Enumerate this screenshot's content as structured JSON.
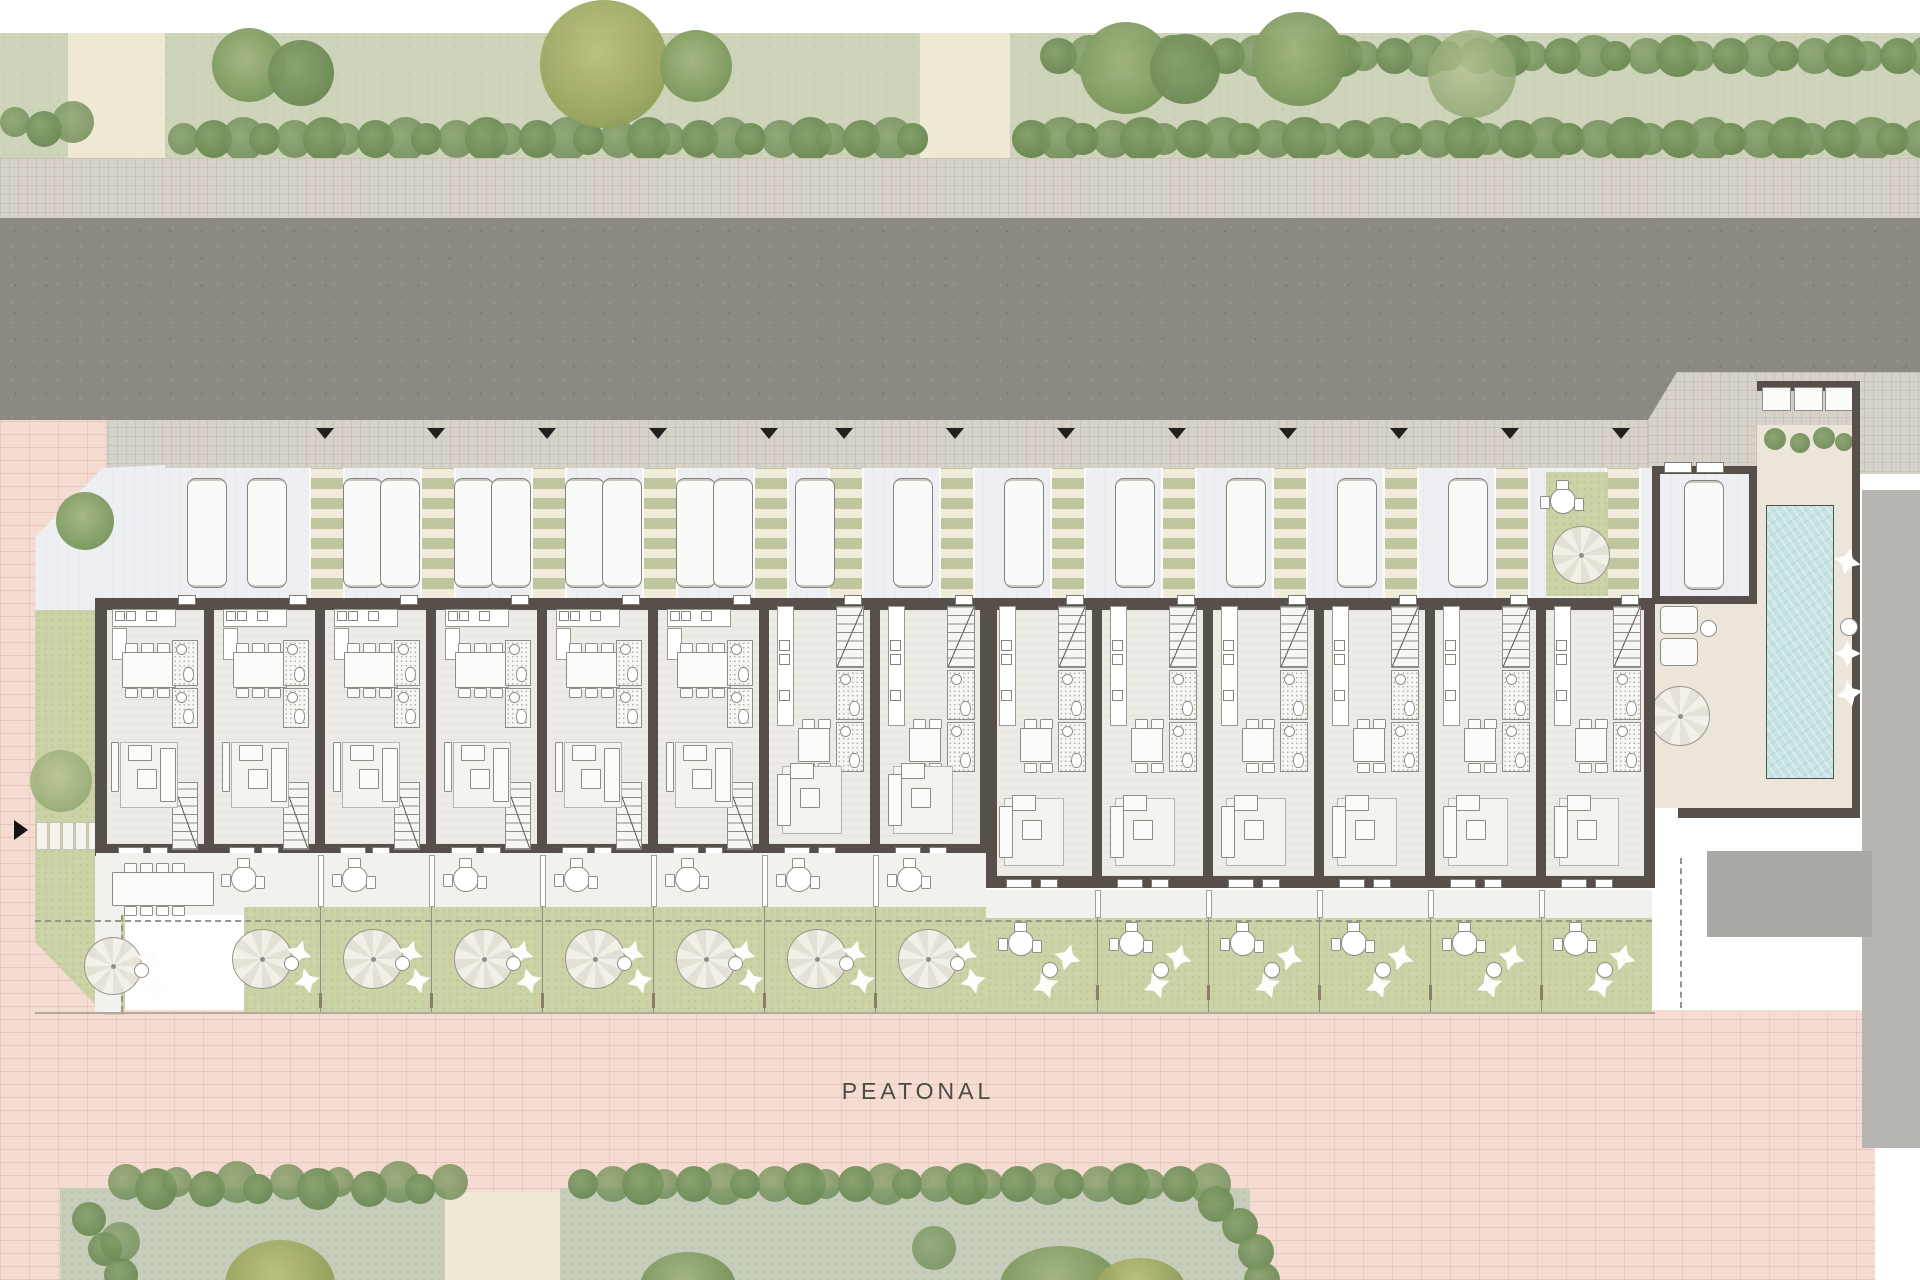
{
  "plan": {
    "street_label": "PEATONAL",
    "row_house_count": 14,
    "wide_unit_count": 6,
    "narrow_unit_count": 8,
    "corner_unit_count": 1,
    "parking_walkway_count": 13,
    "parking_car_count": 19,
    "garage_car_count": 1,
    "amenities": [
      "swimming pool",
      "pool deck",
      "private gardens",
      "street parking court",
      "pedestrian promenade"
    ],
    "per_unit_furniture": [
      "kitchen counter",
      "dining table",
      "bathroom",
      "stairs",
      "sofa",
      "coffee table",
      "patio bistro table",
      "garden parasol",
      "bean bags"
    ]
  },
  "colors": {
    "road": "#8d8882",
    "sidewalk": "#d7d2c9",
    "paving_pink": "#f5dcd2",
    "top_lawn": "#cdd4ba",
    "garden_lawn": "#cbd2a6",
    "hedge_green": "#6c8a54",
    "walkway_green": "#bfc69e",
    "building_wall": "#57504a",
    "interior_floor": "#edebe6",
    "pool_water": "#c6e3e1",
    "pool_deck": "#ece5da",
    "side_lot_gray": "#b6b5b1"
  }
}
